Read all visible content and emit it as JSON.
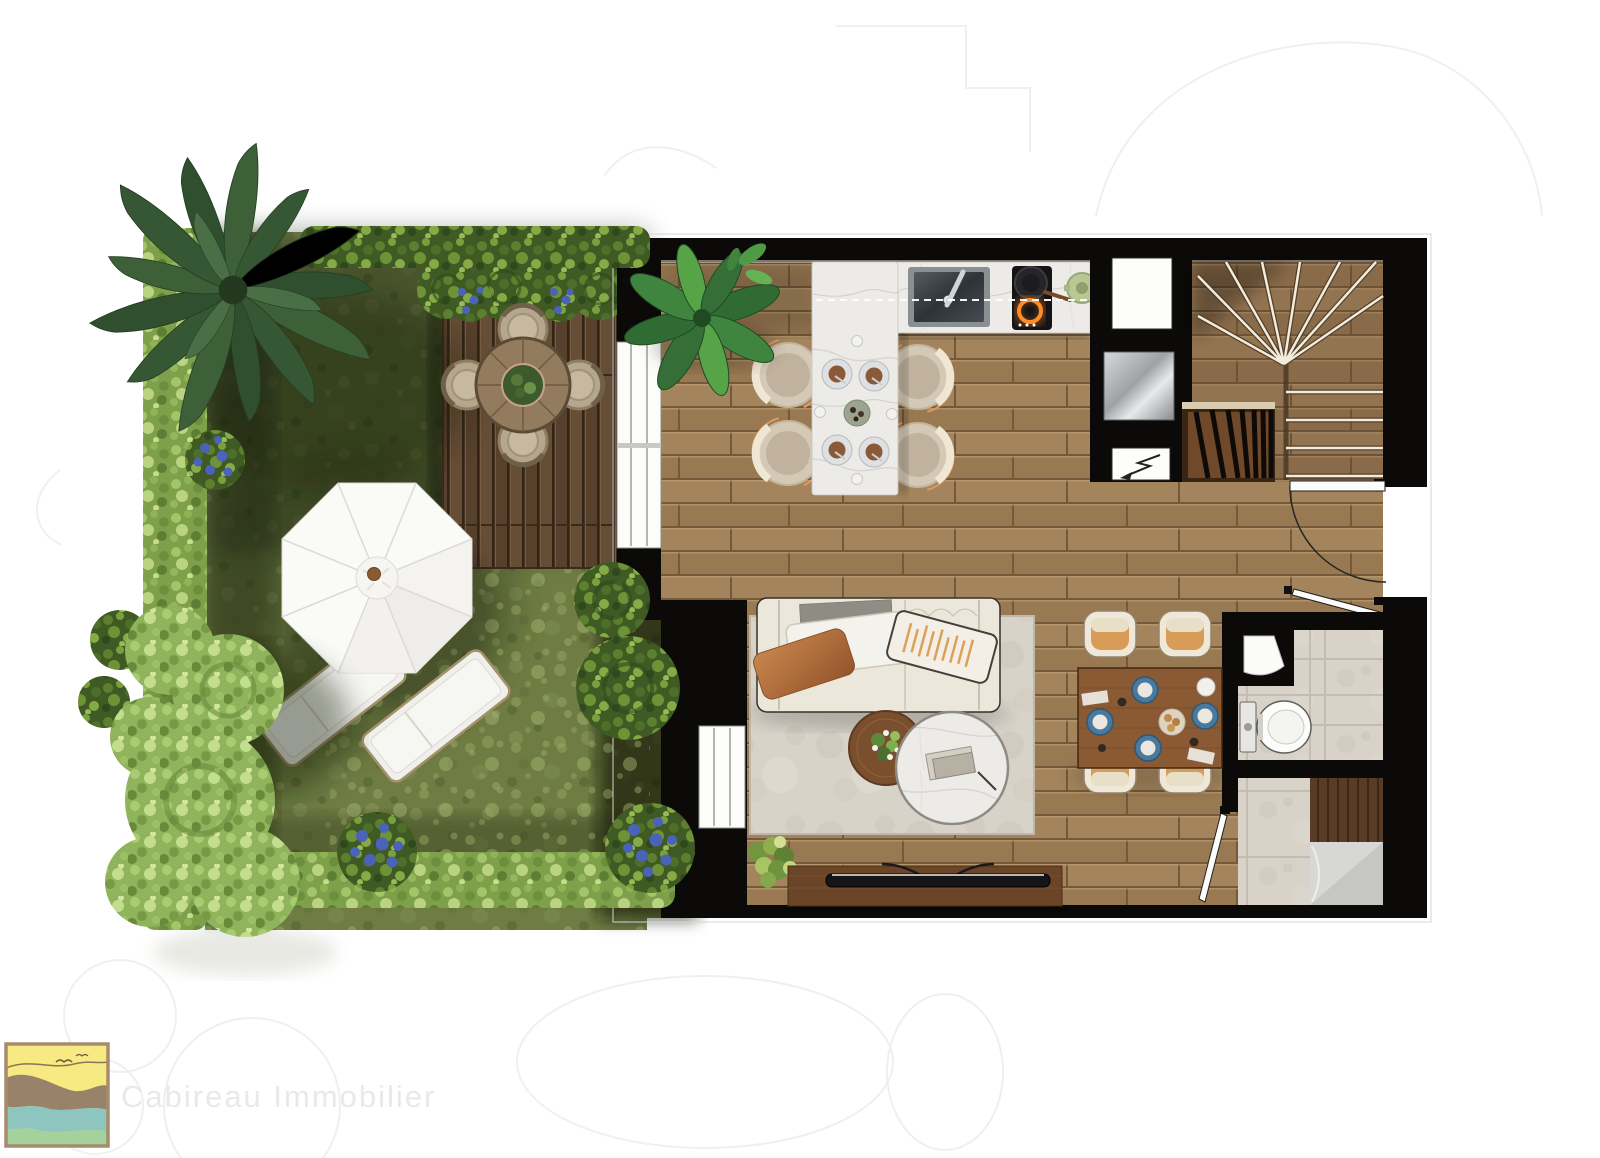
{
  "branding": {
    "company_name": "Cabireau Immobilier",
    "logo_colors": {
      "border": "#a68c6c",
      "sky": "#f7ea82",
      "birds": "#6b5a42",
      "sand_wave": "#99826a",
      "sea_wave": "#8ec6bf",
      "grass_wave": "#a5d19d"
    }
  },
  "plan": {
    "style": "photoreal top-down rendered floor plan with private garden",
    "outdoor": {
      "name": "garden-terrace",
      "elements": [
        "lawn",
        "perimeter-hedges",
        "palm-tree",
        "round-topiary-bushes",
        "blue-flower-shrubs",
        "trees",
        "timber-deck",
        "round-outdoor-dining-table",
        "4-wicker-chairs",
        "white-parasol",
        "2-sun-loungers"
      ]
    },
    "rooms": [
      {
        "name": "kitchen-dining",
        "elements": [
          "l-shaped-marble-counter",
          "undermount-sink",
          "induction-hob-with-pan",
          "green-casserole",
          "marble-island-with-4-place-settings",
          "4-bar-stools",
          "tall-white-cabinet",
          "stainless-appliance",
          "potted-banana-plant",
          "sliding-door-to-deck"
        ]
      },
      {
        "name": "living-area",
        "elements": [
          "three-seat-cream-sofa",
          "throw-pillows",
          "area-rug",
          "round-timber-side-table-with-flowers",
          "round-marble-coffee-table-with-books",
          "tv-sideboard",
          "floor-plant",
          "window-to-garden"
        ]
      },
      {
        "name": "dining-corner",
        "elements": [
          "rectangular-wood-table-set-for-4",
          "4-upholstered-chairs",
          "blue-tableware"
        ]
      },
      {
        "name": "entrance-stair-hall",
        "elements": [
          "winder-staircase",
          "timber-balustrade",
          "entrance-door-with-swing",
          "signal-arrow-panel"
        ]
      },
      {
        "name": "wc",
        "elements": [
          "wall-hung-toilet",
          "corner-washbasin",
          "stone-tiles"
        ]
      },
      {
        "name": "shower-room",
        "elements": [
          "walk-in-shower",
          "teak-bench",
          "stone-tiles",
          "hinged-door"
        ]
      }
    ],
    "palette": {
      "wall": "#0b0a09",
      "wood_floor": "#a2835c",
      "deck": "#5f4733",
      "lawn": "#6f7d44",
      "hedge_dark": "#3f5a23",
      "hedge_light": "#7fa04b",
      "marble": "#edebe7",
      "stone_tile": "#d8d2c8",
      "rug": "#d8d3c9",
      "sofa": "#ebe7db",
      "copper_cushion": "#b26f3f",
      "hob_glow": "#ff8c2a",
      "tableware_blue": "#49799e"
    }
  }
}
